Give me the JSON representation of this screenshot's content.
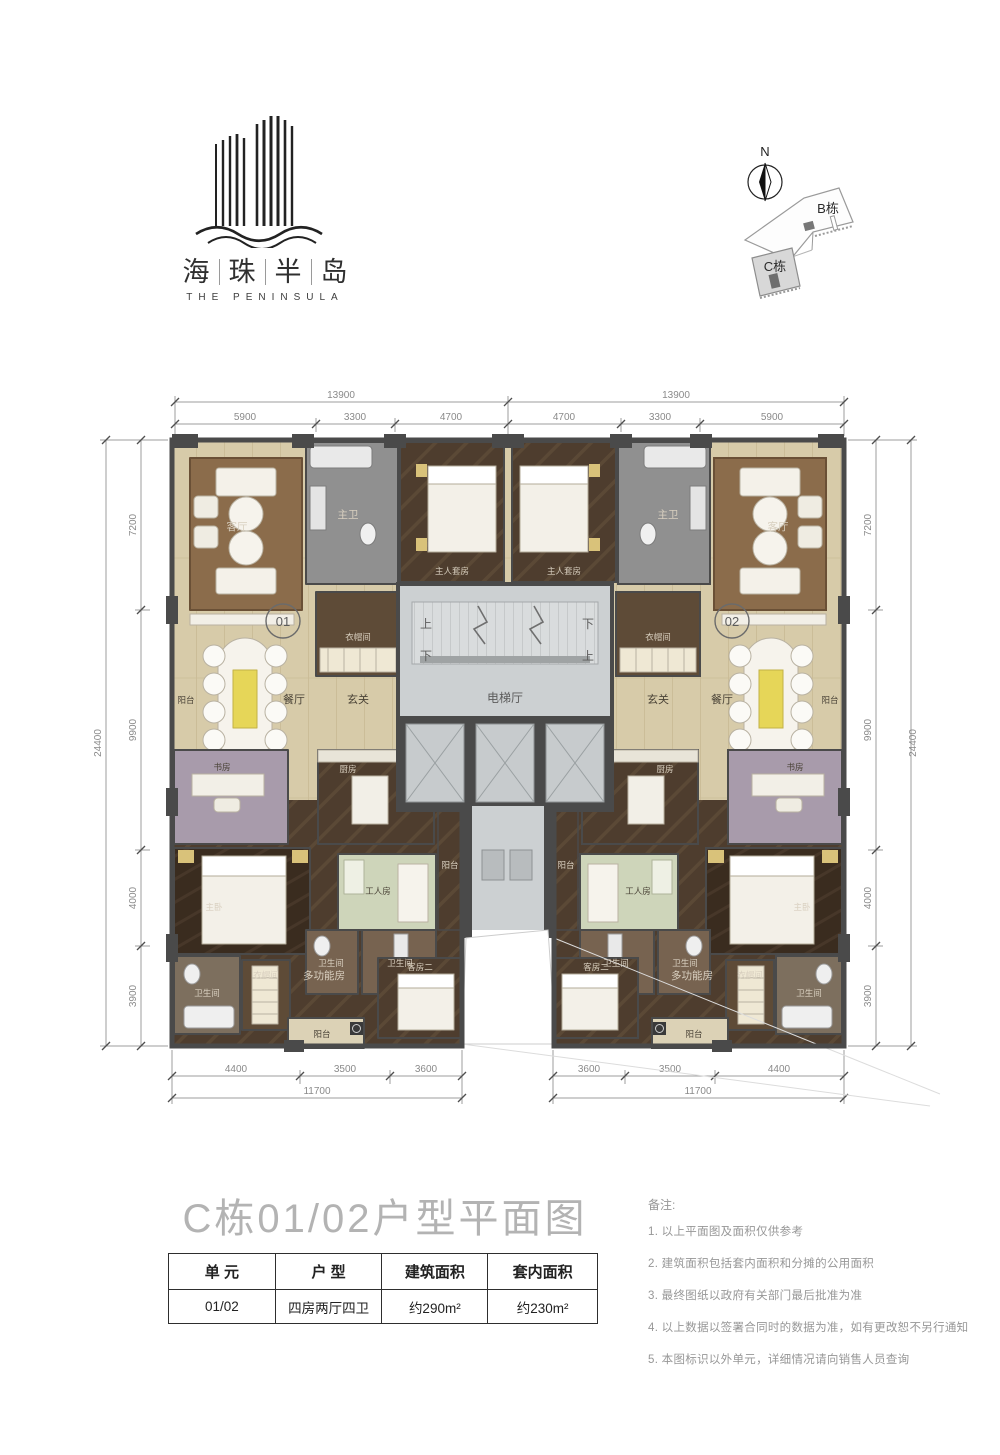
{
  "brand": {
    "chars": [
      "海",
      "珠",
      "半",
      "岛"
    ],
    "en": "THE PENINSULA"
  },
  "compass": {
    "north": "N"
  },
  "site_map": {
    "buildings": [
      {
        "label": "B栋"
      },
      {
        "label": "C栋"
      }
    ]
  },
  "plan": {
    "units": [
      {
        "number": "01"
      },
      {
        "number": "02"
      }
    ],
    "labels": {
      "living": "客厅",
      "master_bath": "主卫",
      "master_suite": "主人套房",
      "cloakroom": "衣帽间",
      "balcony": "阳台",
      "dining": "餐厅",
      "foyer": "玄关",
      "study": "书房",
      "kitchen": "厨房",
      "master_bed": "主卧",
      "worker_room": "工人房",
      "bathroom": "卫生间",
      "multi_room": "多功能房",
      "guest_room2": "客房二",
      "elevator_hall": "电梯厅",
      "up": "上",
      "down": "下"
    },
    "dimensions": {
      "top_totals": [
        "13900",
        "13900"
      ],
      "top_segments": [
        "5900",
        "3300",
        "4700",
        "4700",
        "3300",
        "5900"
      ],
      "side_total": "24400",
      "side_segments": [
        "7200",
        "9900",
        "4000",
        "3900"
      ],
      "bottom_left_segments": [
        "4400",
        "3500",
        "3600"
      ],
      "bottom_left_total": "11700",
      "bottom_right_segments": [
        "3600",
        "3500",
        "4400"
      ],
      "bottom_right_total": "11700"
    }
  },
  "title": "C栋01/02户型平面图",
  "table": {
    "headers": [
      "单 元",
      "户 型",
      "建筑面积",
      "套内面积"
    ],
    "row": [
      "01/02",
      "四房两厅四卫",
      "约290m²",
      "约230m²"
    ]
  },
  "notes": {
    "heading": "备注:",
    "items": [
      "1. 以上平面图及面积仅供参考",
      "2. 建筑面积包括套内面积和分摊的公用面积",
      "3. 最终图纸以政府有关部门最后批准为准",
      "4. 以上数据以签署合同时的数据为准，如有更改恕不另行通知",
      "5. 本图标识以外单元，详细情况请向销售人员查询"
    ]
  }
}
